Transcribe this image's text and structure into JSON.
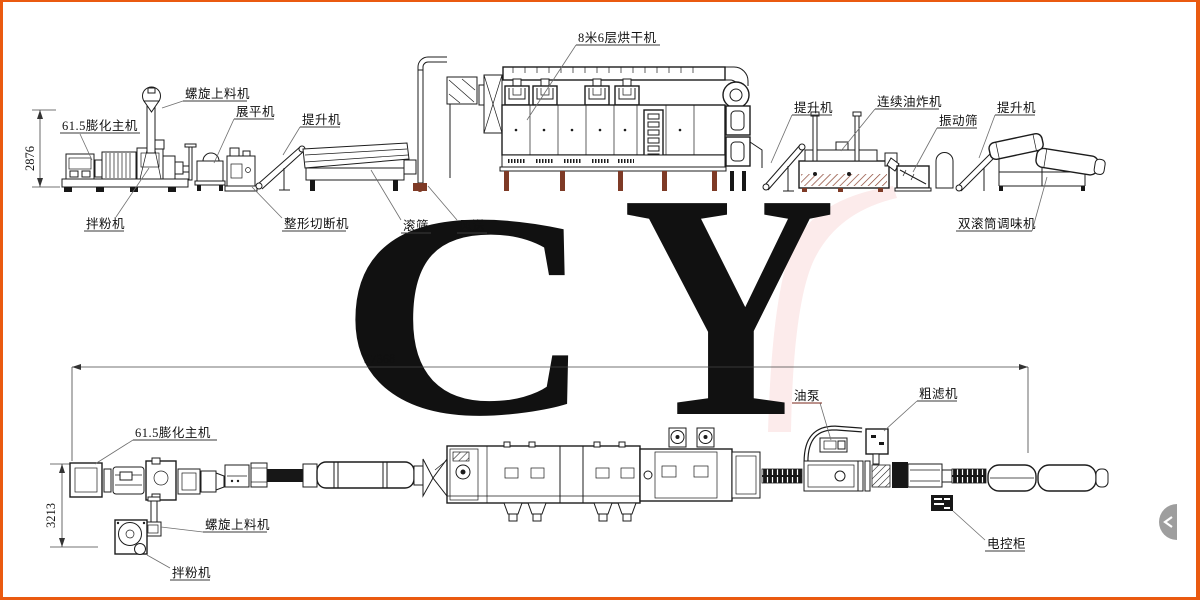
{
  "watermark": {
    "letter_c": "C",
    "letter_y": "Y"
  },
  "colors": {
    "border_orange": "#ea5a10",
    "line_black": "#1c1c1c",
    "accent_brown": "#7e3a26",
    "watermark_light": "#f9d9d9",
    "watermark_red": "#e6605c",
    "oil_pump_label": "#7a2418"
  },
  "top_view": {
    "dim_height": "2876",
    "labels": {
      "extruder": "61.5膨化主机",
      "spiral_feeder": "螺旋上料机",
      "flattener": "展平机",
      "elevator_left": "提升机",
      "mixer": "拌粉机",
      "shaper_cutter": "整形切断机",
      "roller_screen": "滚筛",
      "air_conveyor": "风送",
      "dryer": "8米6层烘干机",
      "elevator_mid": "提升机",
      "fryer": "连续油炸机",
      "vibrating_screen": "振动筛",
      "elevator_right": "提升机",
      "seasoning": "双滚筒调味机"
    }
  },
  "bottom_view": {
    "dim_length": "37368",
    "dim_width": "3213",
    "labels": {
      "extruder": "61.5膨化主机",
      "spiral_feeder": "螺旋上料机",
      "mixer": "拌粉机",
      "oil_pump": "油泵",
      "coarse_filter": "粗滤机",
      "control_cabinet": "电控柜"
    }
  },
  "widgets": {
    "side_toggle": "collapse-panel-toggle"
  }
}
